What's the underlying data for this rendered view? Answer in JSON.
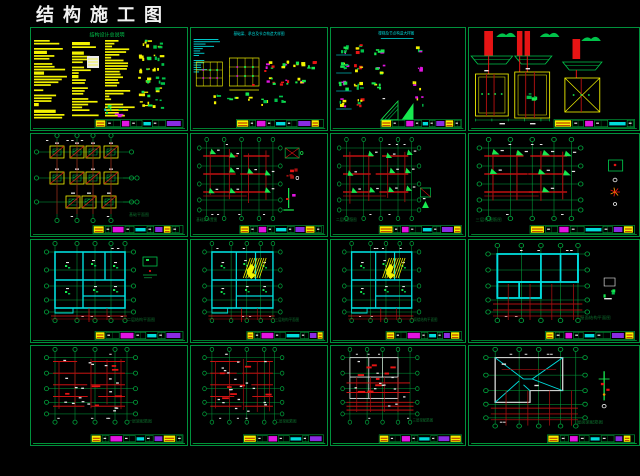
{
  "header": {
    "title": "结构施工图"
  },
  "colors": {
    "background": "#000000",
    "titleText": "#f2f2f2",
    "panelBorder": "#00913c",
    "axis": "#00a83e",
    "green": "#00c24a",
    "brightGreen": "#17e84f",
    "capGreen": "#0e6f2d",
    "red": "#e61414",
    "darkRed": "#a81010",
    "yellow": "#f4f400",
    "cyan": "#00dcdc",
    "magenta": "#e214e2",
    "purple": "#8a2be2",
    "white": "#e6e6e6",
    "orange": "#ff9100"
  },
  "panels": [
    {
      "name": "general-notes-sheet",
      "kind": "notes",
      "seed": 1,
      "title": "结构设计总说明",
      "caption": ""
    },
    {
      "name": "foundation-detail-sheet",
      "kind": "detailsGrid",
      "seed": 2,
      "title": "基础梁、承台及节点构造大样图",
      "caption": ""
    },
    {
      "name": "node-detail-sheet",
      "kind": "detailsScatter",
      "seed": 3,
      "title": "楼梯及节点构造大样图",
      "caption": ""
    },
    {
      "name": "pier-foundation-details",
      "kind": "foundationDetails",
      "seed": 4,
      "caption": ""
    },
    {
      "name": "foundation-plan",
      "kind": "foundationPlan",
      "seed": 5,
      "caption": "基础平面图"
    },
    {
      "name": "ground-beam-plan",
      "kind": "columnPlan",
      "seed": 6,
      "caption": "基础梁布置图",
      "variant": 0
    },
    {
      "name": "column-plan-2f",
      "kind": "columnPlan",
      "seed": 7,
      "caption": "二层柱配筋图",
      "variant": 1
    },
    {
      "name": "column-plan-3f",
      "kind": "columnPlan",
      "seed": 8,
      "caption": "三层柱配筋图",
      "variant": 2
    },
    {
      "name": "floor-plan-2f",
      "kind": "floorPlan",
      "seed": 9,
      "caption": "二层结构平面图",
      "hatch": false,
      "sideDetail": true
    },
    {
      "name": "floor-plan-3f",
      "kind": "floorPlan",
      "seed": 10,
      "caption": "三层结构平面图",
      "hatch": true,
      "sideDetail": false
    },
    {
      "name": "floor-plan-loft",
      "kind": "floorPlan",
      "seed": 11,
      "caption": "阁楼结构平面图",
      "hatch": true,
      "sideDetail": false
    },
    {
      "name": "roof-structure-plan",
      "kind": "roofPlan",
      "seed": 12,
      "caption": "屋面结构平面图"
    },
    {
      "name": "beam-plan-1f",
      "kind": "beamPlan",
      "seed": 13,
      "caption": "一层梁配筋图"
    },
    {
      "name": "beam-plan-2f",
      "kind": "beamPlan",
      "seed": 14,
      "caption": "二层梁配筋图"
    },
    {
      "name": "beam-plan-3f",
      "kind": "beamPlanWalls",
      "seed": 15,
      "caption": "三层梁配筋图"
    },
    {
      "name": "roof-framing-plan",
      "kind": "roofFraming",
      "seed": 16,
      "caption": "屋面梁配筋图"
    }
  ]
}
